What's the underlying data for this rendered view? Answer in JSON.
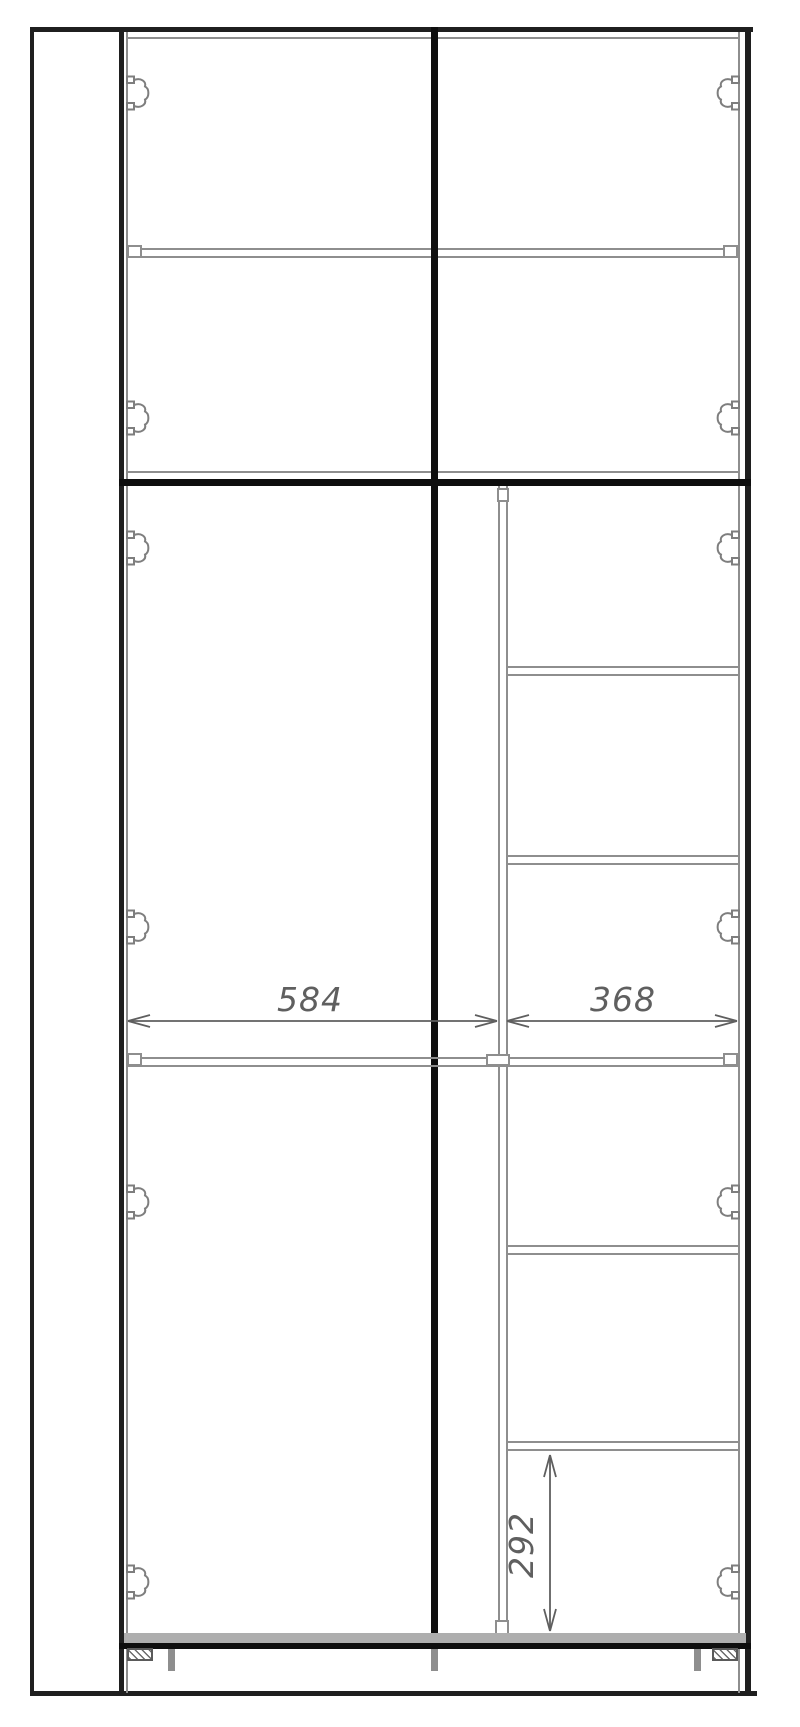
{
  "drawing": {
    "kind": "wardrobe-front-elevation-technical-drawing",
    "annotations": {
      "left_inner_width_mm": "584",
      "right_inner_width_mm": "368",
      "right_shelf_pitch_mm": "292"
    },
    "colors": {
      "dark": "#1f1f1f",
      "black": "#0e0e0e",
      "gray": "#8e8e8e",
      "band": "#aeaeae",
      "dim": "#5f5f5f",
      "hinge": "#7e7e7e",
      "bg": "#ffffff"
    },
    "icons": {
      "hinge": "cup-hinge-icon",
      "foot_plate": "adjustable-foot-icon",
      "leg": "leg-stub"
    },
    "structure": {
      "top_section_doors": 2,
      "bottom_section_doors_stacked": 2,
      "right_column_shelves": 5,
      "hinges_total": 12
    }
  }
}
